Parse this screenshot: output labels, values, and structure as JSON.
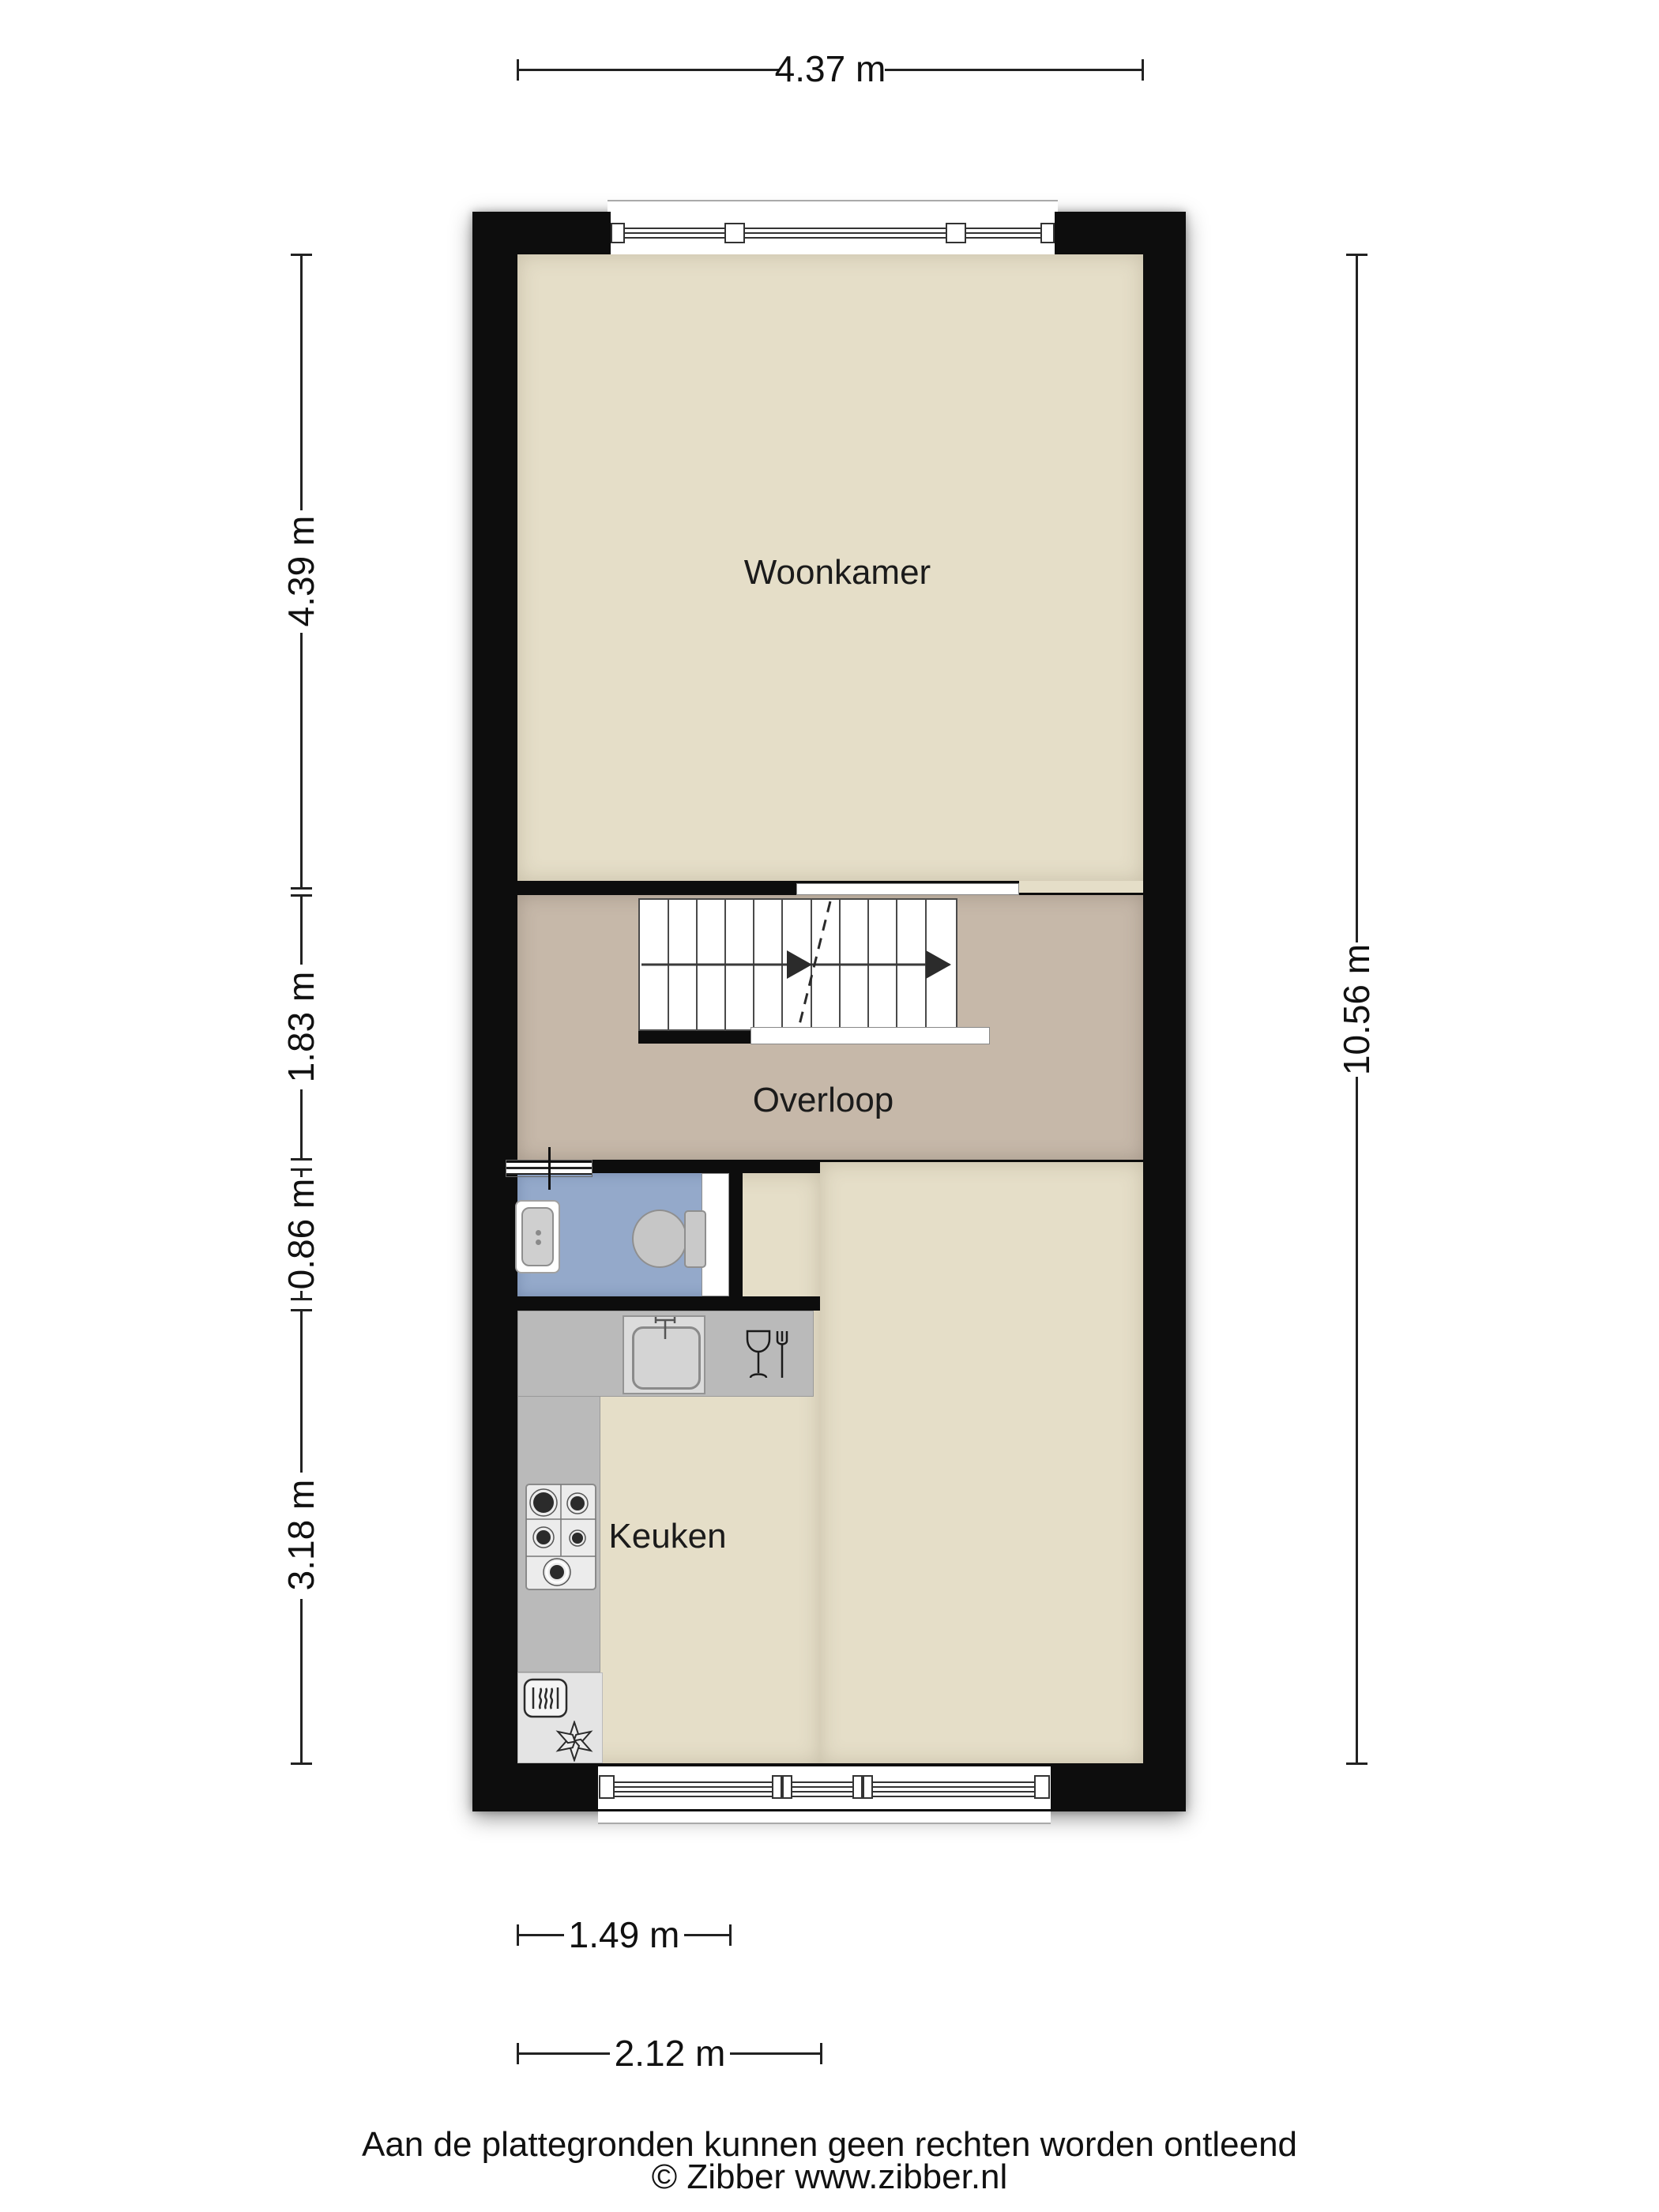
{
  "document": {
    "type": "floor-plan"
  },
  "rooms": {
    "woonkamer": {
      "label": "Woonkamer"
    },
    "overloop": {
      "label": "Overloop"
    },
    "keuken": {
      "label": "Keuken"
    }
  },
  "dimensions": {
    "top": {
      "label": "4.37 m"
    },
    "left": [
      {
        "label": "4.39 m"
      },
      {
        "label": "1.83 m"
      },
      {
        "label": "0.86 m"
      },
      {
        "label": "3.18 m"
      }
    ],
    "right": {
      "label": "10.56 m"
    },
    "bottom": [
      {
        "label": "1.49 m"
      },
      {
        "label": "2.12 m"
      }
    ]
  },
  "footer": {
    "disclaimer": "Aan de plattegronden kunnen geen rechten worden ontleend",
    "copyright": "© Zibber www.zibber.nl"
  },
  "colors": {
    "wall": "#0d0d0d",
    "room_floor": "#e5dec8",
    "landing_floor": "#c6b8a9",
    "toilet_floor": "#94a9ca",
    "counter": "#bababa",
    "appliance_zone": "#e4e4e4",
    "background": "#ffffff"
  }
}
